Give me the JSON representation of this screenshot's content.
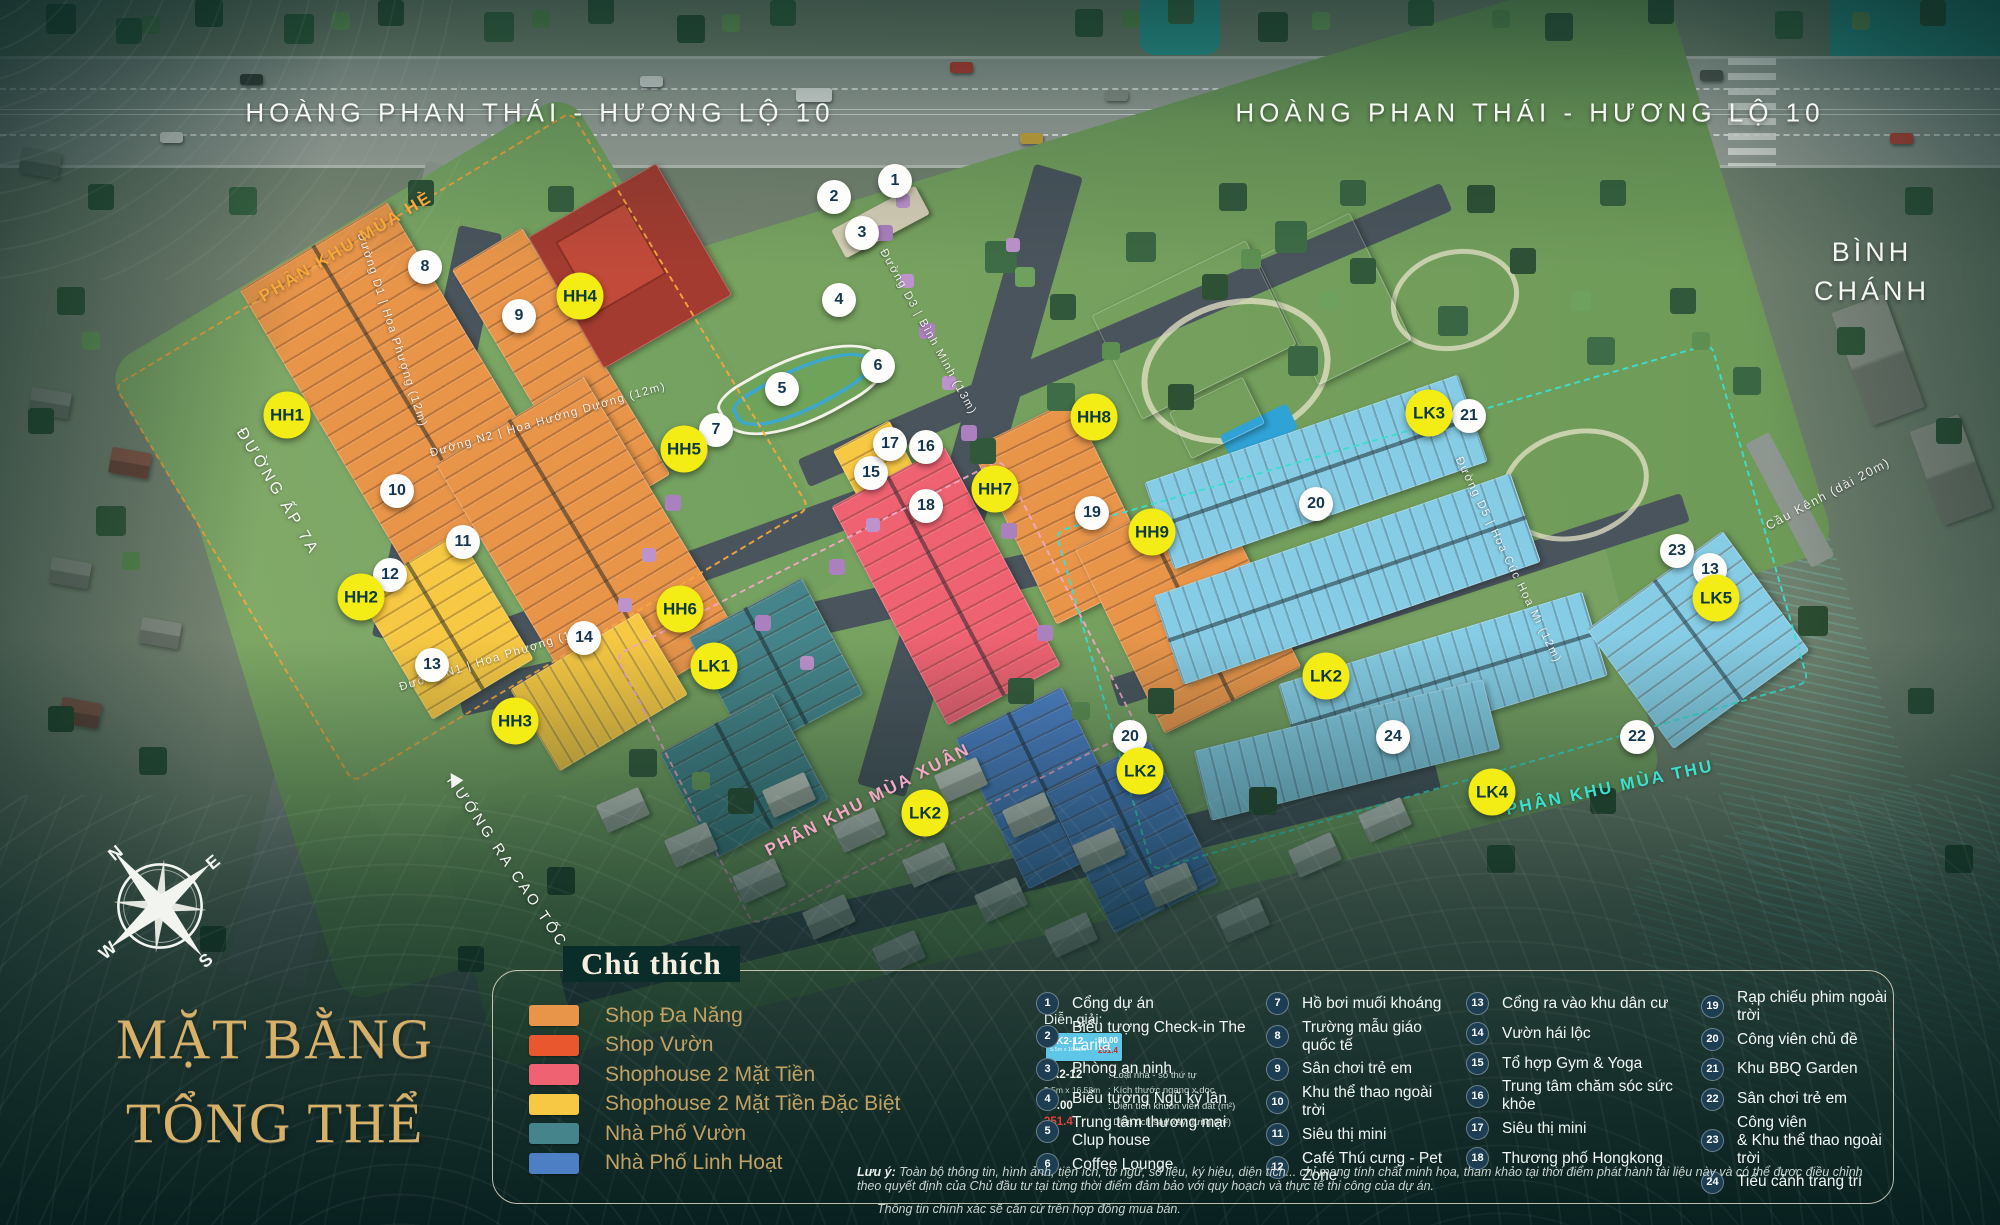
{
  "title": {
    "line1": "MẶT BẰNG",
    "line2": "TỔNG THỂ"
  },
  "map": {
    "road_top_left": "HOÀNG PHAN THÁI - HƯƠNG LỘ 10",
    "road_top_right": "HOÀNG PHAN THÁI - HƯƠNG LỘ 10",
    "district": "BÌNH CHÁNH",
    "road_ap7a": "ĐƯỜNG ẤP 7A",
    "road_highway": "HƯỚNG RA CAO TỐC",
    "bridge": "Cầu Kênh (dài 20m)",
    "compass": {
      "n": "N",
      "e": "E",
      "s": "S",
      "w": "W"
    },
    "zones": [
      {
        "label": "PHÂN KHU MÙA HÈ",
        "color": "#F6A83C",
        "x": 346,
        "y": 247,
        "rot": -31
      },
      {
        "label": "PHÂN KHU MÙA XUÂN",
        "color": "#F2A8C6",
        "x": 868,
        "y": 800,
        "rot": -27
      },
      {
        "label": "PHÂN KHU MÙA THU",
        "color": "#3BE0CE",
        "x": 1610,
        "y": 788,
        "rot": -12
      }
    ],
    "streets": [
      {
        "text": "Đường D3 | Bình Minh (13m)",
        "x": 928,
        "y": 332,
        "rot": 61
      },
      {
        "text": "Đường D1 | Hoa Phượng (12m)",
        "x": 392,
        "y": 330,
        "rot": 72
      },
      {
        "text": "Đường N2 | Hoa Hướng Dương (12m)",
        "x": 548,
        "y": 420,
        "rot": -16
      },
      {
        "text": "Đường N1 | Hoa Phượng (12m)",
        "x": 497,
        "y": 658,
        "rot": -17
      },
      {
        "text": "Đường D5 | Hoa Cúc Họa Mi (12m)",
        "x": 1508,
        "y": 560,
        "rot": 64
      }
    ],
    "block_labels": [
      {
        "code": "HH1",
        "x": 287,
        "y": 415
      },
      {
        "code": "HH2",
        "x": 361,
        "y": 597
      },
      {
        "code": "HH3",
        "x": 515,
        "y": 721
      },
      {
        "code": "HH4",
        "x": 580,
        "y": 296
      },
      {
        "code": "HH5",
        "x": 684,
        "y": 449
      },
      {
        "code": "HH6",
        "x": 680,
        "y": 609
      },
      {
        "code": "HH7",
        "x": 995,
        "y": 489
      },
      {
        "code": "HH8",
        "x": 1094,
        "y": 417
      },
      {
        "code": "HH9",
        "x": 1152,
        "y": 532
      },
      {
        "code": "LK1",
        "x": 714,
        "y": 666
      },
      {
        "code": "LK2",
        "x": 925,
        "y": 813
      },
      {
        "code": "LK2",
        "x": 1140,
        "y": 771
      },
      {
        "code": "LK2",
        "x": 1326,
        "y": 676
      },
      {
        "code": "LK3",
        "x": 1429,
        "y": 413
      },
      {
        "code": "LK4",
        "x": 1492,
        "y": 792
      },
      {
        "code": "LK5",
        "x": 1716,
        "y": 598
      }
    ],
    "markers": [
      {
        "n": "1",
        "x": 895,
        "y": 181
      },
      {
        "n": "2",
        "x": 834,
        "y": 197
      },
      {
        "n": "3",
        "x": 862,
        "y": 233
      },
      {
        "n": "4",
        "x": 839,
        "y": 300
      },
      {
        "n": "5",
        "x": 782,
        "y": 389
      },
      {
        "n": "6",
        "x": 878,
        "y": 366
      },
      {
        "n": "7",
        "x": 716,
        "y": 430
      },
      {
        "n": "8",
        "x": 425,
        "y": 267
      },
      {
        "n": "9",
        "x": 519,
        "y": 316
      },
      {
        "n": "10",
        "x": 397,
        "y": 491
      },
      {
        "n": "11",
        "x": 463,
        "y": 542
      },
      {
        "n": "12",
        "x": 390,
        "y": 575
      },
      {
        "n": "13",
        "x": 432,
        "y": 665
      },
      {
        "n": "14",
        "x": 584,
        "y": 638
      },
      {
        "n": "15",
        "x": 871,
        "y": 473
      },
      {
        "n": "16",
        "x": 926,
        "y": 447
      },
      {
        "n": "17",
        "x": 890,
        "y": 444
      },
      {
        "n": "18",
        "x": 926,
        "y": 506
      },
      {
        "n": "19",
        "x": 1092,
        "y": 513
      },
      {
        "n": "20",
        "x": 1316,
        "y": 504
      },
      {
        "n": "20",
        "x": 1130,
        "y": 737
      },
      {
        "n": "21",
        "x": 1469,
        "y": 416
      },
      {
        "n": "22",
        "x": 1637,
        "y": 737
      },
      {
        "n": "23",
        "x": 1677,
        "y": 551
      },
      {
        "n": "13",
        "x": 1710,
        "y": 570
      },
      {
        "n": "24",
        "x": 1393,
        "y": 737
      }
    ]
  },
  "legend": {
    "title": "Chú thích",
    "types": [
      {
        "label": "Shop Đa Năng",
        "color": "#E8954A"
      },
      {
        "label": "Shop Vườn",
        "color": "#E8572E"
      },
      {
        "label": "Shophouse 2 Mặt Tiền",
        "color": "#EE6272"
      },
      {
        "label": "Shophouse 2 Mặt Tiền Đặc Biệt",
        "color": "#F7C843"
      },
      {
        "label": "Nhà Phố Vườn",
        "color": "#45848A"
      },
      {
        "label": "Nhà Phố Linh Hoạt",
        "color": "#4D7FC4"
      }
    ],
    "explain": {
      "title": "Diễn giải:",
      "sample": {
        "code": "LK2-12",
        "dims": "5.5m x 16.58m",
        "area": "80.00",
        "floor": "251.4"
      },
      "rows": [
        {
          "value": "LK2-12",
          "desc": ": Loại nhà - số thứ tự"
        },
        {
          "value": "5.5m x 16.58m",
          "desc": ": Kích thước ngang x dọc",
          "small": true
        },
        {
          "value": "80.00",
          "desc": ": Diện tích khuôn viên đất (m²)"
        },
        {
          "value": "251.4",
          "desc": ": Diện tích sàn xây dựng (m²)",
          "red": true
        }
      ]
    },
    "poi_cols": [
      [
        {
          "n": "1",
          "label": "Cổng dự án"
        },
        {
          "n": "2",
          "label": "Biểu tượng Check-in The Larita"
        },
        {
          "n": "3",
          "label": "Phòng an ninh"
        },
        {
          "n": "4",
          "label": "Biểu tượng Ngũ kỳ lân"
        },
        {
          "n": "5",
          "label": "Trung tâm thương mại\nClup house"
        },
        {
          "n": "6",
          "label": "Coffee Lounge"
        }
      ],
      [
        {
          "n": "7",
          "label": "Hồ bơi muối khoáng"
        },
        {
          "n": "8",
          "label": "Trường mẫu giáo quốc tế"
        },
        {
          "n": "9",
          "label": "Sân chơi trẻ em"
        },
        {
          "n": "10",
          "label": "Khu thể thao ngoài trời"
        },
        {
          "n": "11",
          "label": "Siêu thị mini"
        },
        {
          "n": "12",
          "label": "Café Thú cưng - Pet Zone"
        }
      ],
      [
        {
          "n": "13",
          "label": "Cổng ra vào khu dân cư"
        },
        {
          "n": "14",
          "label": "Vườn hái lộc"
        },
        {
          "n": "15",
          "label": "Tổ hợp Gym & Yoga"
        },
        {
          "n": "16",
          "label": "Trung tâm chăm sóc sức khỏe"
        },
        {
          "n": "17",
          "label": "Siêu thị mini"
        },
        {
          "n": "18",
          "label": "Thương phố Hongkong"
        }
      ],
      [
        {
          "n": "19",
          "label": "Rạp chiếu phim ngoài trời"
        },
        {
          "n": "20",
          "label": "Công viên chủ đề"
        },
        {
          "n": "21",
          "label": "Khu BBQ Garden"
        },
        {
          "n": "22",
          "label": "Sân chơi trẻ em"
        },
        {
          "n": "23",
          "label": "Công viên\n& Khu thể thao ngoài trời"
        },
        {
          "n": "24",
          "label": "Tiểu cảnh trang trí"
        }
      ]
    ],
    "note_label": "Lưu ý:",
    "note_line1": "Toàn bộ thông tin, hình ảnh, tiện ích, từ ngữ, số liệu, ký hiệu, diện tích... chỉ mang tính chất minh họa, tham khảo tại thời điểm phát hành tài liệu này và có thể được điều chỉnh theo quyết định của Chủ đầu tư tại từng thời điểm đảm bảo với quy hoạch và thực tế thi công của dự án.",
    "note_line2": "Thông tin chính xác sẽ căn cứ trên hợp đồng mua bán."
  }
}
